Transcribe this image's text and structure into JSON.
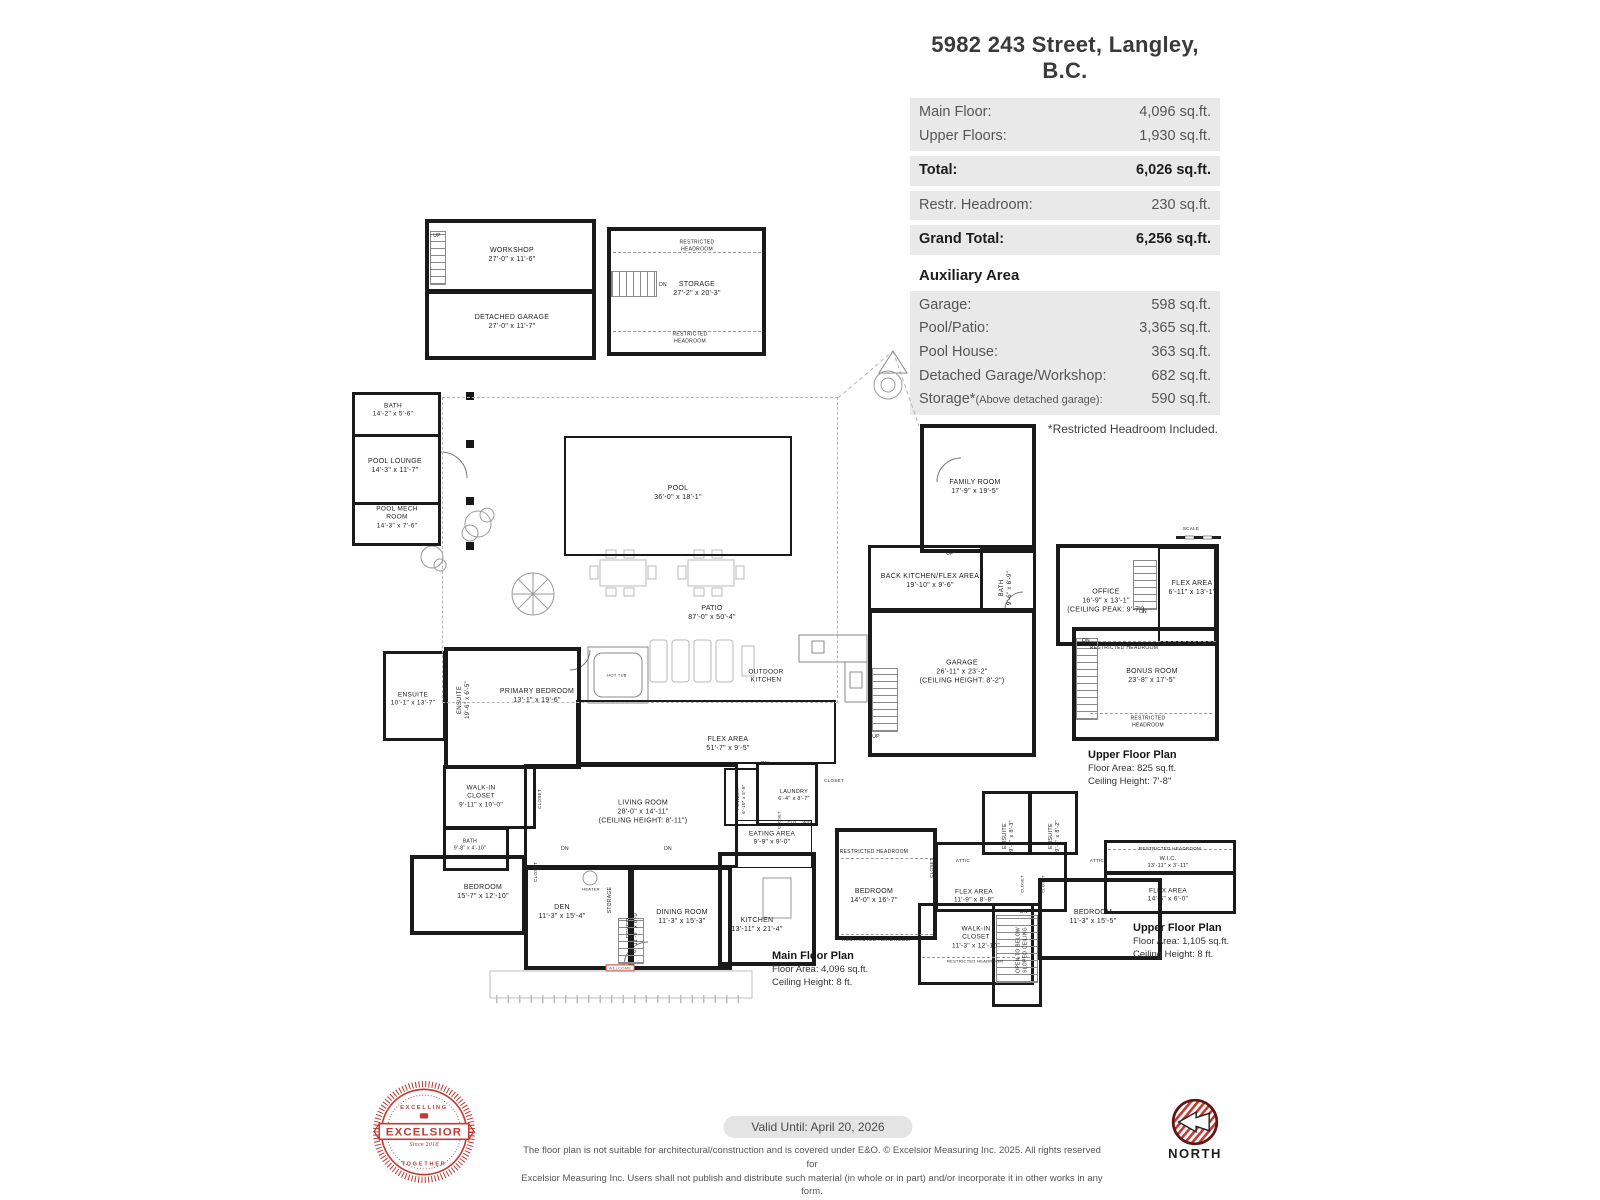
{
  "header": {
    "title": "5982 243 Street, Langley, B.C.",
    "main_groups": [
      [
        {
          "label": "Main Floor:",
          "value": "4,096 sq.ft.",
          "bold": false
        },
        {
          "label": "Upper Floors:",
          "value": "1,930 sq.ft.",
          "bold": false
        }
      ],
      [
        {
          "label": "Total:",
          "value": "6,026 sq.ft.",
          "bold": true
        }
      ],
      [
        {
          "label": "Restr. Headroom:",
          "value": "230 sq.ft.",
          "bold": false
        }
      ],
      [
        {
          "label": "Grand Total:",
          "value": "6,256 sq.ft.",
          "bold": true
        }
      ]
    ],
    "aux_heading": "Auxiliary Area",
    "aux_rows": [
      {
        "label": "Garage:",
        "value": "598 sq.ft."
      },
      {
        "label": "Pool/Patio:",
        "value": "3,365 sq.ft."
      },
      {
        "label": "Pool House:",
        "value": "363 sq.ft."
      },
      {
        "label": "Detached Garage/Workshop:",
        "value": "682 sq.ft."
      },
      {
        "label": "Storage*",
        "label_small": "(Above detached garage):",
        "value": "590 sq.ft."
      }
    ],
    "footnote": "*Restricted Headroom Included."
  },
  "plan": {
    "walls": [
      {
        "x": 425,
        "y": 219,
        "w": 171,
        "h": 74,
        "t": 4
      },
      {
        "x": 425,
        "y": 290,
        "w": 171,
        "h": 70,
        "t": 4
      },
      {
        "x": 607,
        "y": 227,
        "w": 159,
        "h": 129,
        "t": 4
      },
      {
        "x": 352,
        "y": 392,
        "w": 89,
        "h": 45,
        "t": 3
      },
      {
        "x": 352,
        "y": 434,
        "w": 89,
        "h": 71,
        "t": 3
      },
      {
        "x": 352,
        "y": 502,
        "w": 89,
        "h": 44,
        "t": 3
      },
      {
        "x": 564,
        "y": 436,
        "w": 228,
        "h": 120,
        "t": 2
      },
      {
        "x": 920,
        "y": 424,
        "w": 116,
        "h": 129,
        "t": 4
      },
      {
        "x": 868,
        "y": 545,
        "w": 168,
        "h": 66,
        "t": 3
      },
      {
        "x": 980,
        "y": 548,
        "w": 56,
        "h": 63,
        "t": 3
      },
      {
        "x": 868,
        "y": 609,
        "w": 168,
        "h": 148,
        "t": 4
      },
      {
        "x": 1056,
        "y": 544,
        "w": 163,
        "h": 102,
        "t": 4
      },
      {
        "x": 1158,
        "y": 547,
        "w": 58,
        "h": 96,
        "t": 2
      },
      {
        "x": 1072,
        "y": 627,
        "w": 147,
        "h": 114,
        "t": 4
      },
      {
        "x": 383,
        "y": 651,
        "w": 63,
        "h": 90,
        "t": 3
      },
      {
        "x": 444,
        "y": 647,
        "w": 137,
        "h": 122,
        "t": 4
      },
      {
        "x": 443,
        "y": 765,
        "w": 93,
        "h": 64,
        "t": 3
      },
      {
        "x": 443,
        "y": 827,
        "w": 66,
        "h": 44,
        "t": 3
      },
      {
        "x": 410,
        "y": 855,
        "w": 116,
        "h": 80,
        "t": 4
      },
      {
        "x": 524,
        "y": 866,
        "w": 108,
        "h": 104,
        "t": 4
      },
      {
        "x": 630,
        "y": 866,
        "w": 102,
        "h": 104,
        "t": 4
      },
      {
        "x": 718,
        "y": 852,
        "w": 98,
        "h": 114,
        "t": 4
      },
      {
        "x": 524,
        "y": 764,
        "w": 214,
        "h": 104,
        "t": 3
      },
      {
        "x": 576,
        "y": 700,
        "w": 260,
        "h": 64,
        "t": 2
      },
      {
        "x": 724,
        "y": 768,
        "w": 34,
        "h": 58,
        "t": 2
      },
      {
        "x": 756,
        "y": 762,
        "w": 62,
        "h": 64,
        "t": 3
      },
      {
        "x": 736,
        "y": 820,
        "w": 76,
        "h": 48,
        "t": 1
      },
      {
        "x": 835,
        "y": 828,
        "w": 102,
        "h": 112,
        "t": 4
      },
      {
        "x": 935,
        "y": 842,
        "w": 132,
        "h": 70,
        "t": 3
      },
      {
        "x": 982,
        "y": 791,
        "w": 49,
        "h": 64,
        "t": 3
      },
      {
        "x": 1029,
        "y": 791,
        "w": 49,
        "h": 64,
        "t": 3
      },
      {
        "x": 1038,
        "y": 878,
        "w": 124,
        "h": 82,
        "t": 4
      },
      {
        "x": 1104,
        "y": 840,
        "w": 132,
        "h": 34,
        "t": 3
      },
      {
        "x": 1104,
        "y": 872,
        "w": 132,
        "h": 42,
        "t": 3
      },
      {
        "x": 918,
        "y": 903,
        "w": 116,
        "h": 82,
        "t": 3
      },
      {
        "x": 992,
        "y": 903,
        "w": 50,
        "h": 104,
        "t": 3
      },
      {
        "x": 442,
        "y": 397,
        "w": 396,
        "h": 306,
        "t": 1,
        "dashed": true
      }
    ],
    "stairs": [
      {
        "x": 430,
        "y": 231,
        "w": 16,
        "h": 54,
        "d": "v"
      },
      {
        "x": 611,
        "y": 271,
        "w": 46,
        "h": 26,
        "d": "h"
      },
      {
        "x": 872,
        "y": 668,
        "w": 26,
        "h": 64,
        "d": "v"
      },
      {
        "x": 1076,
        "y": 638,
        "w": 22,
        "h": 82,
        "d": "v"
      },
      {
        "x": 1133,
        "y": 560,
        "w": 24,
        "h": 50,
        "d": "v"
      },
      {
        "x": 618,
        "y": 918,
        "w": 26,
        "h": 46,
        "d": "v"
      },
      {
        "x": 996,
        "y": 915,
        "w": 42,
        "h": 68,
        "d": "v"
      }
    ],
    "dashes": [
      {
        "x": 613,
        "y": 252,
        "w": 148
      },
      {
        "x": 613,
        "y": 331,
        "w": 148
      },
      {
        "x": 1078,
        "y": 641,
        "w": 138
      },
      {
        "x": 1090,
        "y": 713,
        "w": 122
      },
      {
        "x": 841,
        "y": 858,
        "w": 92
      },
      {
        "x": 841,
        "y": 934,
        "w": 92
      },
      {
        "x": 1108,
        "y": 849,
        "w": 124
      },
      {
        "x": 922,
        "y": 957,
        "w": 108
      }
    ],
    "labels": [
      {
        "lines": [
          "UP"
        ],
        "x": 437,
        "y": 236,
        "fs": 5
      },
      {
        "lines": [
          "WORKSHOP",
          "27'-0\" x 11'-6\""
        ],
        "x": 512,
        "y": 255
      },
      {
        "lines": [
          "DETACHED GARAGE",
          "27'-0\" x 11'-7\""
        ],
        "x": 512,
        "y": 322
      },
      {
        "lines": [
          "DN"
        ],
        "x": 663,
        "y": 285,
        "fs": 5
      },
      {
        "lines": [
          "STORAGE",
          "27'-2\" x 20'-3\""
        ],
        "x": 697,
        "y": 289
      },
      {
        "lines": [
          "RESTRICTED",
          "HEADROOM"
        ],
        "x": 697,
        "y": 246,
        "fs": 5
      },
      {
        "lines": [
          "RESTRICTED",
          "HEADROOM"
        ],
        "x": 690,
        "y": 338,
        "fs": 5
      },
      {
        "lines": [
          "BATH",
          "14'-2\" x 5'-6\""
        ],
        "x": 393,
        "y": 411,
        "fs": 6.5
      },
      {
        "lines": [
          "POOL LOUNGE",
          "14'-3\" x 11'-7\""
        ],
        "x": 395,
        "y": 466
      },
      {
        "lines": [
          "POOL MECH",
          "ROOM",
          "14'-3\" x 7'-6\""
        ],
        "x": 397,
        "y": 518,
        "fs": 6.5
      },
      {
        "lines": [
          "POOL",
          "36'-0\" x 18'-1\""
        ],
        "x": 678,
        "y": 493
      },
      {
        "lines": [
          "PATIO",
          "87'-0\" x 50'-4\""
        ],
        "x": 712,
        "y": 613
      },
      {
        "lines": [
          "HOT TUB"
        ],
        "x": 617,
        "y": 675,
        "fs": 4
      },
      {
        "lines": [
          "OUTDOOR",
          "KITCHEN"
        ],
        "x": 766,
        "y": 677,
        "fs": 6.5
      },
      {
        "lines": [
          "FAMILY ROOM",
          "17'-9\" x 19'-5\""
        ],
        "x": 975,
        "y": 487
      },
      {
        "lines": [
          "UP"
        ],
        "x": 950,
        "y": 554,
        "fs": 5
      },
      {
        "lines": [
          "BACK KITCHEN/FLEX AREA",
          "19'-10\" x 9'-6\""
        ],
        "x": 930,
        "y": 581
      },
      {
        "lines": [
          "BATH",
          "9'-6\" x 6'-9\""
        ],
        "x": 1007,
        "y": 588,
        "r": -90,
        "fs": 6
      },
      {
        "lines": [
          "GARAGE",
          "26'-11\" x 23'-2\"",
          "(CEILING HEIGHT: 8'-2\")"
        ],
        "x": 962,
        "y": 672
      },
      {
        "lines": [
          "SCALE"
        ],
        "x": 1191,
        "y": 529,
        "fs": 4.5
      },
      {
        "lines": [
          "OFFICE",
          "16'-9\" x 13'-1\"",
          "(CEILING PEAK: 9'-7\")"
        ],
        "x": 1106,
        "y": 601
      },
      {
        "lines": [
          "FLEX AREA",
          "6'-11\" x 13'-1\""
        ],
        "x": 1192,
        "y": 588
      },
      {
        "lines": [
          "DN"
        ],
        "x": 1143,
        "y": 612,
        "fs": 5
      },
      {
        "lines": [
          "DN"
        ],
        "x": 1086,
        "y": 641,
        "fs": 5
      },
      {
        "lines": [
          "RESTRICTED HEADROOM"
        ],
        "x": 1124,
        "y": 648,
        "fs": 5
      },
      {
        "lines": [
          "BONUS ROOM",
          "23'-8\" x 17'-5\""
        ],
        "x": 1152,
        "y": 676
      },
      {
        "lines": [
          "RESTRICTED",
          "HEADROOM"
        ],
        "x": 1148,
        "y": 722,
        "fs": 5
      },
      {
        "lines": [
          "ENSUITE",
          "10'-1\" x 13'-7\""
        ],
        "x": 413,
        "y": 700,
        "fs": 6.5
      },
      {
        "lines": [
          "ENSUITE",
          "19'-6\" x 6'-5\""
        ],
        "x": 465,
        "y": 700,
        "r": -90,
        "fs": 6
      },
      {
        "lines": [
          "PRIMARY BEDROOM",
          "13'-1\" x 19'-6\""
        ],
        "x": 537,
        "y": 696
      },
      {
        "lines": [
          "WALK-IN",
          "CLOSET",
          "9'-11\" x 10'-0\""
        ],
        "x": 481,
        "y": 797,
        "fs": 6.5
      },
      {
        "lines": [
          "CLOSET"
        ],
        "x": 540,
        "y": 799,
        "r": -90,
        "fs": 4.5
      },
      {
        "lines": [
          "FLEX AREA",
          "51'-7\" x 9'-5\""
        ],
        "x": 728,
        "y": 744
      },
      {
        "lines": [
          "DN"
        ],
        "x": 765,
        "y": 764,
        "fs": 5
      },
      {
        "lines": [
          "LIVING ROOM",
          "28'-0\" x 14'-11\"",
          "(CEILING HEIGHT: 8'-11\")"
        ],
        "x": 643,
        "y": 812
      },
      {
        "lines": [
          "POWDER",
          "6'-10\" x 5'-8\""
        ],
        "x": 741,
        "y": 799,
        "r": -90,
        "fs": 4.5
      },
      {
        "lines": [
          "LAUNDRY",
          "6'-4\" x 8'-7\""
        ],
        "x": 794,
        "y": 796,
        "fs": 5.5
      },
      {
        "lines": [
          "CLOSET"
        ],
        "x": 834,
        "y": 781,
        "fs": 4.5
      },
      {
        "lines": [
          "CLOSET"
        ],
        "x": 779,
        "y": 820,
        "r": -90,
        "fs": 4
      },
      {
        "lines": [
          "CLO"
        ],
        "x": 792,
        "y": 822,
        "fs": 4
      },
      {
        "lines": [
          "W/D"
        ],
        "x": 807,
        "y": 822,
        "fs": 4
      },
      {
        "lines": [
          "EATING AREA",
          "9'-9\" x 9'-0\""
        ],
        "x": 772,
        "y": 839,
        "fs": 6.5
      },
      {
        "lines": [
          "DN"
        ],
        "x": 565,
        "y": 849,
        "fs": 5
      },
      {
        "lines": [
          "DN"
        ],
        "x": 668,
        "y": 849,
        "fs": 5
      },
      {
        "lines": [
          "BATH",
          "9'-8\" x 4'-10\""
        ],
        "x": 470,
        "y": 845,
        "fs": 5
      },
      {
        "lines": [
          "BEDROOM",
          "15'-7\" x 12'-10\""
        ],
        "x": 483,
        "y": 892
      },
      {
        "lines": [
          "CLOSET"
        ],
        "x": 536,
        "y": 872,
        "r": -90,
        "fs": 4.5
      },
      {
        "lines": [
          "DEN",
          "11'-3\" x 15'-4\""
        ],
        "x": 562,
        "y": 912
      },
      {
        "lines": [
          "HEATER"
        ],
        "x": 591,
        "y": 889,
        "fs": 4
      },
      {
        "lines": [
          "STORAGE"
        ],
        "x": 610,
        "y": 900,
        "r": -90,
        "fs": 5
      },
      {
        "lines": [
          "FOYER",
          "11'-9\" x 8'-0\""
        ],
        "x": 633,
        "y": 928,
        "r": -90,
        "fs": 5.5
      },
      {
        "lines": [
          "UP"
        ],
        "x": 633,
        "y": 953,
        "fs": 5
      },
      {
        "lines": [
          "DINING ROOM",
          "11'-3\" x 15'-3\""
        ],
        "x": 682,
        "y": 917
      },
      {
        "lines": [
          "KITCHEN",
          "13'-11\" x 21'-4\""
        ],
        "x": 757,
        "y": 925
      },
      {
        "lines": [
          "WELCOME"
        ],
        "x": 620,
        "y": 968,
        "fs": 4,
        "cls": "welcome"
      },
      {
        "lines": [
          "RESTRICTED HEADROOM"
        ],
        "x": 874,
        "y": 852,
        "fs": 5
      },
      {
        "lines": [
          "BEDROOM",
          "14'-0\" x 16'-7\""
        ],
        "x": 874,
        "y": 896
      },
      {
        "lines": [
          "RESTRICTED HEADROOM"
        ],
        "x": 876,
        "y": 940,
        "fs": 5
      },
      {
        "lines": [
          "CLOSET"
        ],
        "x": 932,
        "y": 868,
        "r": -90,
        "fs": 4.5
      },
      {
        "lines": [
          "ATTIC"
        ],
        "x": 963,
        "y": 861,
        "fs": 4.5
      },
      {
        "lines": [
          "FLEX AREA",
          "11'-9\" x 8'-8\""
        ],
        "x": 974,
        "y": 897,
        "fs": 6.5
      },
      {
        "lines": [
          "ENSUITE",
          "9'-8\" x 8'-3\""
        ],
        "x": 1009,
        "y": 836,
        "r": -90,
        "fs": 5.5
      },
      {
        "lines": [
          "ENSUITE",
          "9'-8\" x 8'-2\""
        ],
        "x": 1055,
        "y": 836,
        "r": -90,
        "fs": 5.5
      },
      {
        "lines": [
          "CLOSET"
        ],
        "x": 1022,
        "y": 884,
        "r": -90,
        "fs": 4
      },
      {
        "lines": [
          "CLOSET"
        ],
        "x": 1043,
        "y": 884,
        "r": -90,
        "fs": 4
      },
      {
        "lines": [
          "ATTIC"
        ],
        "x": 1097,
        "y": 861,
        "fs": 4.5
      },
      {
        "lines": [
          "BEDROOM",
          "11'-3\" x 15'-5\""
        ],
        "x": 1093,
        "y": 917
      },
      {
        "lines": [
          "RESTRICTED HEADROOM"
        ],
        "x": 1170,
        "y": 849,
        "fs": 4.5
      },
      {
        "lines": [
          "W.I.C.",
          "13'-11\" x 3'-11\""
        ],
        "x": 1168,
        "y": 863,
        "fs": 5.5
      },
      {
        "lines": [
          "FLEX AREA",
          "14'-6\" x 6'-0\""
        ],
        "x": 1168,
        "y": 896,
        "fs": 6.5
      },
      {
        "lines": [
          "WALK-IN",
          "CLOSET",
          "11'-3\" x 12'-10\""
        ],
        "x": 976,
        "y": 938,
        "fs": 6.5
      },
      {
        "lines": [
          "RESTRICTED HEADROOM"
        ],
        "x": 975,
        "y": 961,
        "fs": 4
      },
      {
        "lines": [
          "DN"
        ],
        "x": 1024,
        "y": 912,
        "fs": 5
      },
      {
        "lines": [
          "OPEN TO BELOW",
          "SLOPED CEILING"
        ],
        "x": 1022,
        "y": 950,
        "r": -90,
        "fs": 5
      },
      {
        "lines": [
          "UP"
        ],
        "x": 876,
        "y": 737,
        "fs": 5
      }
    ],
    "plan_titles": [
      {
        "x": 1088,
        "y": 748,
        "title": "Upper Floor Plan",
        "lines": [
          "Floor Area: 825 sq.ft.",
          "Ceiling Height: 7'-8\""
        ]
      },
      {
        "x": 772,
        "y": 949,
        "title": "Main Floor Plan",
        "lines": [
          "Floor Area: 4,096 sq.ft.",
          "Ceiling Height: 8 ft."
        ]
      },
      {
        "x": 1133,
        "y": 921,
        "title": "Upper Floor Plan",
        "lines": [
          "Floor Area: 1,105 sq.ft.",
          "Ceiling Height: 8 ft."
        ]
      }
    ]
  },
  "footer": {
    "valid_until": "Valid Until: April 20, 2026",
    "disclaimer_line1": "The floor plan is not suitable for architectural/construction and is covered under E&O. © Excelsior Measuring Inc. 2025. All rights reserved for",
    "disclaimer_line2": "Excelsior Measuring Inc. Users shall not publish and distribute such material (in whole or in part) and/or incorporate it in other works in any form.",
    "logo": {
      "top": "EXCELLING",
      "middle": "EXCELSIOR",
      "bottom": "TOGETHER",
      "since": "Since 2018"
    },
    "north_label": "NORTH"
  },
  "colors": {
    "accent_red": "#c23b33",
    "wall": "#1a1a1a",
    "row_bg": "#e9e9e9"
  }
}
